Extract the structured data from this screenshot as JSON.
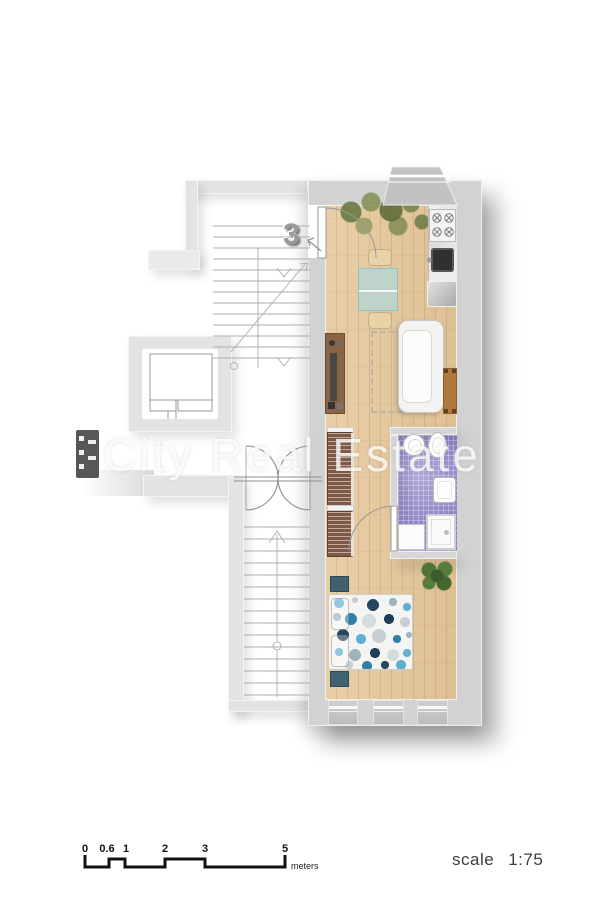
{
  "watermark": {
    "text": "City Real Estate"
  },
  "apartment": {
    "number": "3"
  },
  "scale_bar": {
    "labels": [
      "0",
      "0.6",
      "1",
      "2",
      "3",
      "5"
    ],
    "unit": "meters"
  },
  "scale_note": {
    "label": "scale",
    "ratio": "1:75"
  },
  "palette": {
    "wall": "#d6d6d6",
    "wall_light": "#e3e3e3",
    "wood_floor": "#e6c99e",
    "bathroom_tile": "#8d84c6",
    "wardrobe_brown": "#7d5a48",
    "sofa_white": "#f3f3f1",
    "table_glass": "#b7d6d1",
    "chair_beige": "#e8d3a9",
    "console_brown": "#8a6446",
    "side_table_brown": "#b07a3e",
    "nightstand_teal": "#41616f",
    "bed_dot_blue": "#5fb0d0",
    "bed_dot_navy": "#24465f",
    "plant_green": "#5e7f42",
    "plan_line": "#a9a9a9",
    "scale_bar_black": "#111111"
  }
}
